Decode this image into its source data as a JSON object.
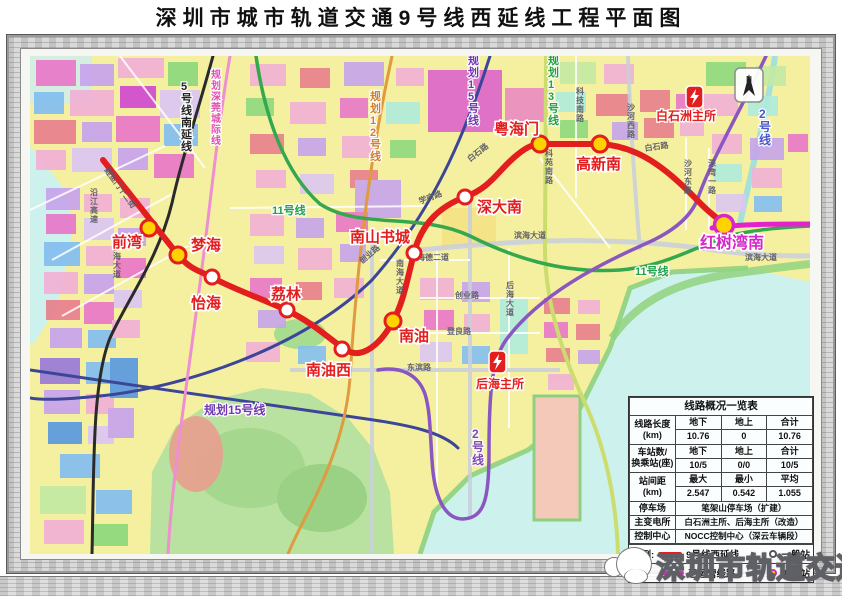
{
  "header": {
    "title": "深圳市城市轨道交通9号线西延线工程平面图"
  },
  "map": {
    "compass_label": "N",
    "line_colors": {
      "line9_ext": "#e31e1e",
      "line9_existing": "#e322ce",
      "line11": "#35a84e",
      "line2": "#8a56c0",
      "line5": "#2a2a2a",
      "line12_planned": "#e09a40",
      "line13_planned": "#cbdd6e",
      "line15_planned": "#3c4698",
      "intercity": "#ee8fd0"
    },
    "lines": [
      {
        "id": "line13-planned",
        "color": "#cbdd6e",
        "w": 4,
        "d": "M546,58 L545,250 C545,300 560,352 585,405 C603,444 616,495 618,556"
      },
      {
        "id": "line15-planned-north",
        "color": "#3c4698",
        "w": 3,
        "d": "M490,58 C464,140 432,214 372,282 C300,352 180,390 100,398 C60,402 42,402 30,400"
      },
      {
        "id": "line15-planned-south",
        "color": "#3c4698",
        "w": 3,
        "d": "M30,372 C140,388 260,406 360,420 C410,427 442,434 458,450"
      },
      {
        "id": "line12-planned",
        "color": "#e09a40",
        "w": 3,
        "d": "M392,58 C372,150 358,250 350,380 C344,460 302,520 288,556"
      },
      {
        "id": "shenguan-intercity-planned",
        "color": "#ee8fd0",
        "w": 3,
        "d": "M230,58 C216,140 208,230 198,300 C188,380 172,480 168,556"
      },
      {
        "id": "line5-south-extension",
        "color": "#2a2a2a",
        "w": 3,
        "d": "M213,58 C196,120 182,160 172,205 C158,262 128,300 110,340 C92,385 94,470 92,556"
      },
      {
        "id": "line11",
        "color": "#35a84e",
        "w": 3.5,
        "d": "M256,58 C265,120 285,175 320,206 C360,232 420,214 470,238 C510,258 560,276 620,272 C668,268 700,246 732,237 C765,230 792,229 810,228"
      },
      {
        "id": "line2",
        "color": "#8a56c0",
        "w": 3.5,
        "d": "M766,58 C742,110 712,160 698,200 C690,222 668,236 645,246 C600,266 540,296 506,342 C492,362 489,392 489,455 C489,502 484,520 463,521 C444,521 434,498 432,462 C430,432 430,412 425,396 C418,376 400,368 378,372"
      },
      {
        "id": "line9-existing",
        "color": "#e322ce",
        "w": 5,
        "d": "M712,230 C740,226 775,226 810,226"
      },
      {
        "id": "line9-west-extension",
        "color": "#e31e1e",
        "w": 6,
        "d": "M103,162 L178,257 C192,273 199,272 213,280 C238,293 263,301 288,313 C312,324 332,343 346,352 C362,362 381,346 393,323 C403,305 406,287 414,255 C422,224 441,208 465,199 C492,189 498,172 517,157 C528,148 533,146 546,146 L600,146 C642,148 672,176 701,206 C713,218 720,222 727,228"
      }
    ],
    "stations": [
      {
        "name": "前湾",
        "x": 149,
        "y": 230,
        "type": "transfer",
        "lx": 112,
        "ly": 249
      },
      {
        "name": "梦海",
        "x": 178,
        "y": 257,
        "type": "transfer",
        "lx": 191,
        "ly": 252
      },
      {
        "name": "怡海",
        "x": 212,
        "y": 279,
        "type": "regular",
        "lx": 191,
        "ly": 310
      },
      {
        "name": "荔林",
        "x": 287,
        "y": 312,
        "type": "regular",
        "lx": 271,
        "ly": 301
      },
      {
        "name": "南油西",
        "x": 342,
        "y": 351,
        "type": "regular",
        "lx": 306,
        "ly": 377
      },
      {
        "name": "南油",
        "x": 393,
        "y": 323,
        "type": "transfer",
        "lx": 399,
        "ly": 343
      },
      {
        "name": "南山书城",
        "x": 414,
        "y": 255,
        "type": "regular",
        "lx": 350,
        "ly": 244
      },
      {
        "name": "深大南",
        "x": 465,
        "y": 199,
        "type": "regular",
        "lx": 477,
        "ly": 214
      },
      {
        "name": "粤海门",
        "x": 540,
        "y": 146,
        "type": "transfer",
        "lx": 494,
        "ly": 136
      },
      {
        "name": "高新南",
        "x": 600,
        "y": 146,
        "type": "transfer",
        "lx": 576,
        "ly": 171
      },
      {
        "name": "红树湾南",
        "x": 724,
        "y": 227,
        "type": "terminus",
        "lx": 700,
        "ly": 250,
        "color": "#d428c8",
        "fs": 16
      }
    ],
    "line_labels": [
      {
        "text": "5号线南延线",
        "x": 181,
        "y": 92,
        "vertical": true,
        "color": "#222222",
        "fs": 11
      },
      {
        "text": "规划深莞城际线",
        "x": 211,
        "y": 80,
        "vertical": true,
        "color": "#e050b0",
        "fs": 10
      },
      {
        "text": "规划12号线",
        "x": 370,
        "y": 102,
        "vertical": true,
        "color": "#cf7f2f",
        "fs": 11
      },
      {
        "text": "11号线",
        "x": 272,
        "y": 216,
        "color": "#1fa04a",
        "fs": 11
      },
      {
        "text": "11号线",
        "x": 635,
        "y": 277,
        "color": "#1fa04a",
        "fs": 11
      },
      {
        "text": "规划15号线",
        "x": 468,
        "y": 66,
        "vertical": true,
        "color": "#7038b0",
        "fs": 11
      },
      {
        "text": "规划15号线",
        "x": 204,
        "y": 416,
        "color": "#7038b0",
        "fs": 12
      },
      {
        "text": "规划13号线",
        "x": 548,
        "y": 66,
        "vertical": true,
        "color": "#28a040",
        "fs": 11
      },
      {
        "text": "2号线",
        "x": 759,
        "y": 120,
        "vertical": true,
        "color": "#4858c8",
        "fs": 12
      },
      {
        "text": "2号线",
        "x": 472,
        "y": 440,
        "vertical": true,
        "color": "#8048b8",
        "fs": 12
      }
    ],
    "road_labels": [
      {
        "text": "沿江高速",
        "x": 90,
        "y": 197,
        "vertical": true
      },
      {
        "text": "鲤鱼门十二街",
        "x": 104,
        "y": 172,
        "rot": 54
      },
      {
        "text": "梦海大道",
        "x": 113,
        "y": 252,
        "vertical": true
      },
      {
        "text": "白石路",
        "x": 470,
        "y": 164,
        "rot": -38
      },
      {
        "text": "白石路",
        "x": 645,
        "y": 153,
        "rot": -8
      },
      {
        "text": "学府路",
        "x": 420,
        "y": 206,
        "rot": -20
      },
      {
        "text": "科技南路",
        "x": 576,
        "y": 96,
        "vertical": true
      },
      {
        "text": "科苑南路",
        "x": 545,
        "y": 158,
        "vertical": true
      },
      {
        "text": "沙河西路",
        "x": 627,
        "y": 112,
        "vertical": true
      },
      {
        "text": "沙河东路",
        "x": 684,
        "y": 168,
        "vertical": true
      },
      {
        "text": "深湾一路",
        "x": 708,
        "y": 168,
        "vertical": true
      },
      {
        "text": "滨海大道",
        "x": 514,
        "y": 240
      },
      {
        "text": "滨海大道",
        "x": 745,
        "y": 262
      },
      {
        "text": "海德二道",
        "x": 417,
        "y": 262
      },
      {
        "text": "创业路",
        "x": 362,
        "y": 266,
        "rot": -40
      },
      {
        "text": "创业路",
        "x": 455,
        "y": 300
      },
      {
        "text": "登良路",
        "x": 447,
        "y": 336
      },
      {
        "text": "东滨路",
        "x": 407,
        "y": 372
      },
      {
        "text": "南海大道",
        "x": 396,
        "y": 268,
        "vertical": true
      },
      {
        "text": "后海大道",
        "x": 506,
        "y": 290,
        "vertical": true
      }
    ],
    "substations": [
      {
        "name": "白石洲主所",
        "icon_x": 686,
        "icon_y": 88,
        "label_x": 656,
        "label_y": 122
      },
      {
        "name": "后海主所",
        "icon_x": 489,
        "icon_y": 353,
        "label_x": 476,
        "label_y": 390
      }
    ]
  },
  "table": {
    "title": "线路概况一览表",
    "stat_rows": [
      {
        "label": "线路长度\n(km)",
        "heads": [
          "地下",
          "地上",
          "合计"
        ],
        "vals": [
          "10.76",
          "0",
          "10.76"
        ]
      },
      {
        "label": "车站数/\n换乘站(座)",
        "heads": [
          "地下",
          "地上",
          "合计"
        ],
        "vals": [
          "10/5",
          "0/0",
          "10/5"
        ]
      },
      {
        "label": "站间距\n(km)",
        "heads": [
          "最大",
          "最小",
          "平均"
        ],
        "vals": [
          "2.547",
          "0.542",
          "1.055"
        ]
      }
    ],
    "info_rows": [
      {
        "label": "停车场",
        "value": "笔架山停车场（扩建）"
      },
      {
        "label": "主变电所",
        "value": "白石洲主所、后海主所（改造）"
      },
      {
        "label": "控制中心",
        "value": "NOCC控制中心（深云车辆段）"
      }
    ],
    "legend": {
      "prefix": "图例:",
      "row1_line": "9号线西延线",
      "row1_station": "一般站",
      "row2_line": "已运营线路",
      "row2_station": "换乘站",
      "row1_color": "#e31e1e",
      "row2_color": "#e322ce"
    }
  },
  "watermark": {
    "text": "深圳市轨道交通"
  }
}
